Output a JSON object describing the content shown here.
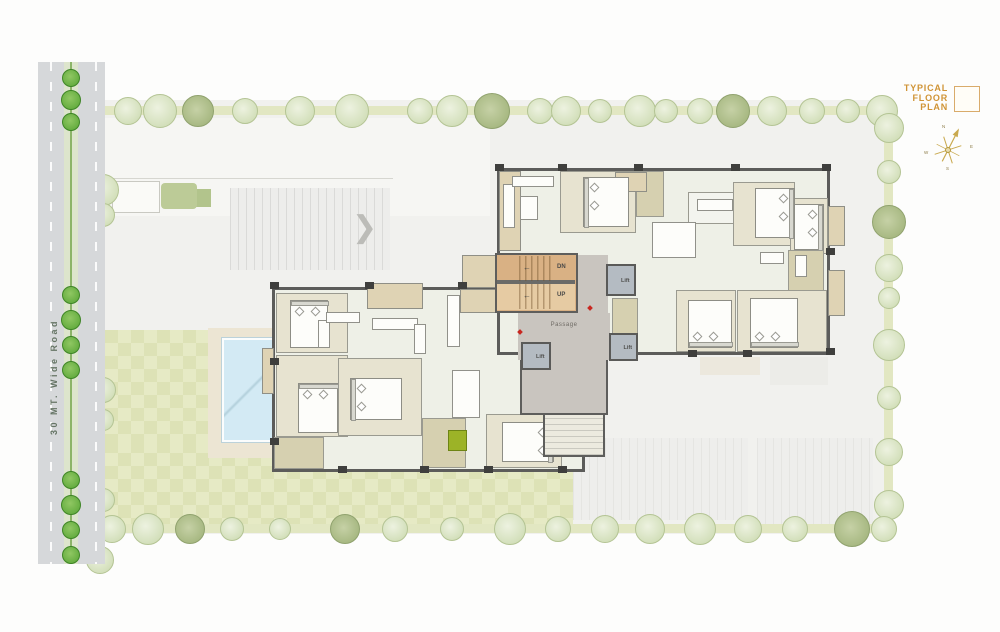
{
  "legend": {
    "title_lines": [
      "TYPICAL",
      "FLOOR",
      "PLAN"
    ]
  },
  "road": {
    "label": "30 MT. Wide Road"
  },
  "core": {
    "dn_label": "DN",
    "up_label": "UP",
    "passage_label": "Passage",
    "lift_label": "Lift",
    "arrow": "←"
  },
  "ramp": {
    "chevron": "❯"
  },
  "compass": {
    "n": "N",
    "e": "E",
    "s": "S",
    "w": "W"
  },
  "icons": {
    "compass": "compass-rose-icon",
    "tree": "tree-icon",
    "chevron": "chevron-right-icon",
    "legend_square": "floor-plan-key-icon"
  },
  "colors": {
    "accent_orange": "#d09436",
    "plot_gray": "#f1f1ee",
    "road_gray": "#d6d8da",
    "lawn_green_a": "#e6eac5",
    "lawn_green_b": "#dde2b6",
    "pool_blue": "#d3eaf4",
    "stair_tan": "#d9b184",
    "passage_gray": "#c9c5bf",
    "lift_gray": "#b4bbc2",
    "tree_sage": "#d8e3c2",
    "tree_road_green": "#57a434",
    "wall_dark": "#5c5c5a"
  }
}
